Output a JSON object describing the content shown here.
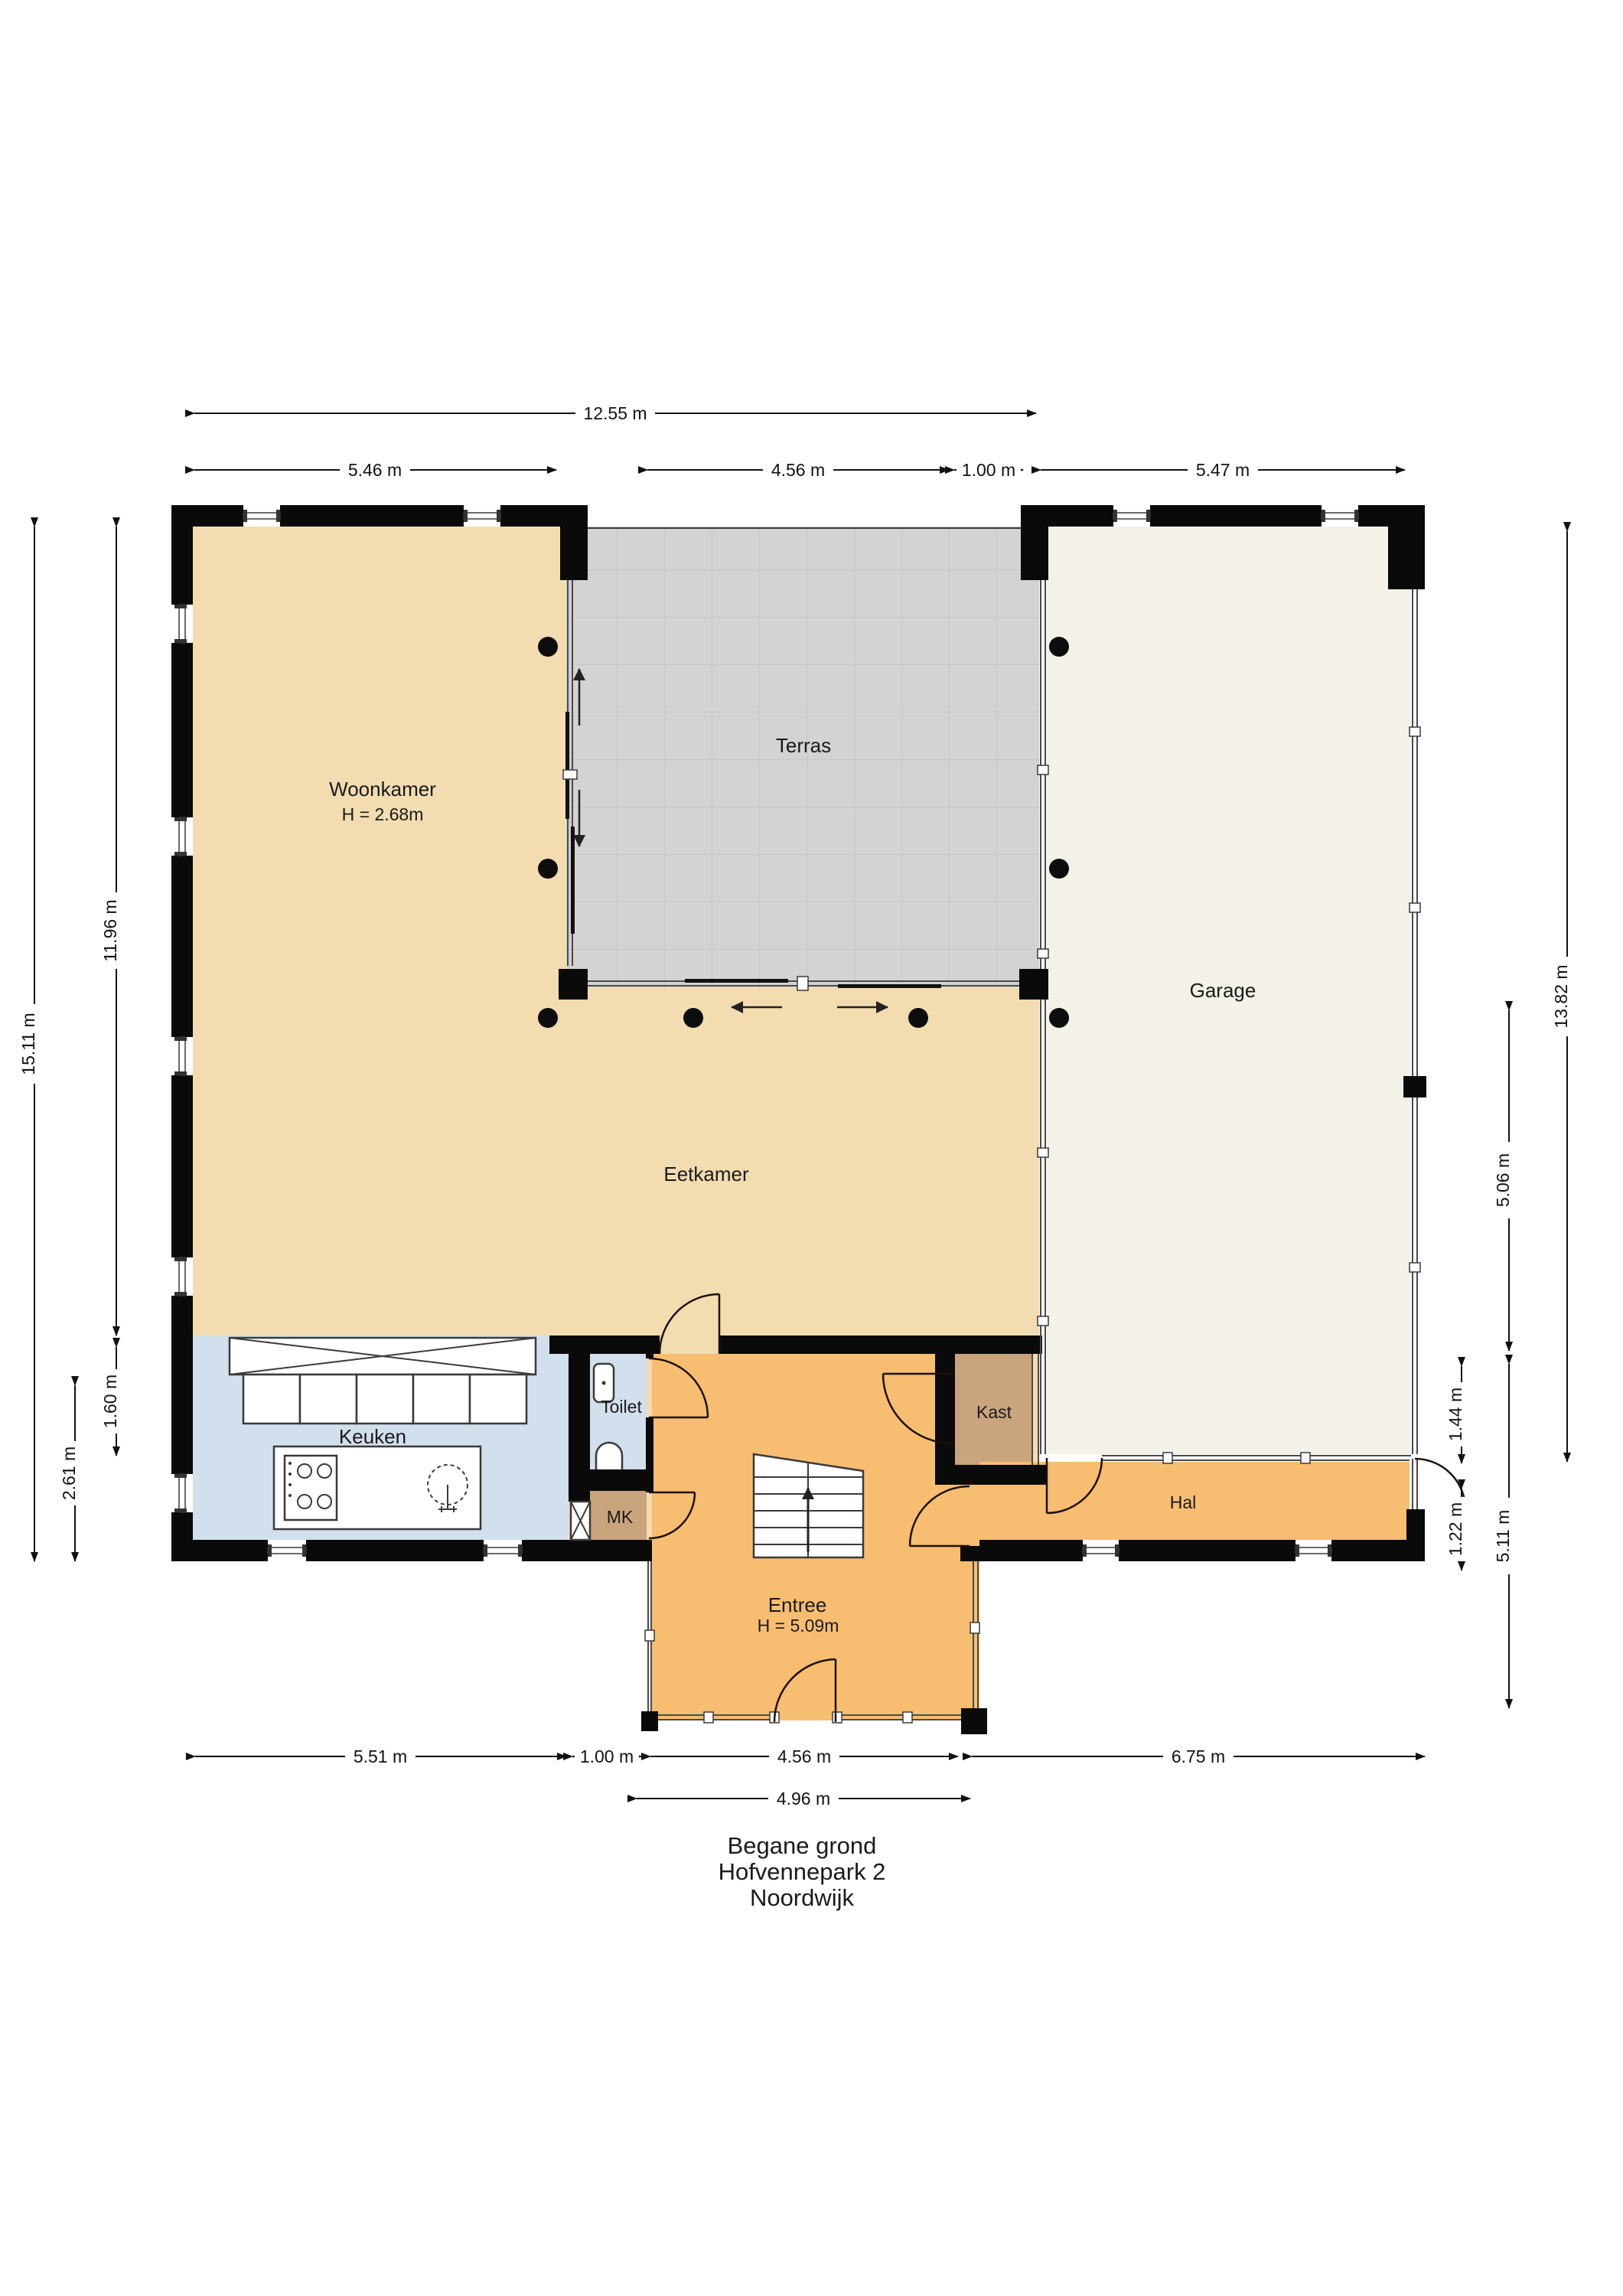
{
  "title_block": {
    "lines": [
      "Begane grond",
      "Hofvennepark 2",
      "Noordwijk"
    ]
  },
  "rooms": {
    "woonkamer": {
      "label": "Woonkamer",
      "height_note": "H = 2.68m"
    },
    "terras": {
      "label": "Terras"
    },
    "garage": {
      "label": "Garage"
    },
    "eetkamer": {
      "label": "Eetkamer"
    },
    "keuken": {
      "label": "Keuken"
    },
    "toilet": {
      "label": "Toilet"
    },
    "mk": {
      "label": "MK"
    },
    "entree": {
      "label": "Entree",
      "height_note": "H = 5.09m"
    },
    "kast": {
      "label": "Kast"
    },
    "hal": {
      "label": "Hal"
    }
  },
  "dimensions": {
    "top": [
      {
        "label": "12.55 m"
      },
      {
        "label": "5.46 m"
      },
      {
        "label": "4.56 m"
      },
      {
        "label": "1.00 m"
      },
      {
        "label": "5.47 m"
      }
    ],
    "bottom": [
      {
        "label": "5.51 m"
      },
      {
        "label": "1.00 m"
      },
      {
        "label": "4.56 m"
      },
      {
        "label": "6.75 m"
      },
      {
        "label": "4.96 m"
      }
    ],
    "left": [
      {
        "label": "15.11 m"
      },
      {
        "label": "11.96 m"
      },
      {
        "label": "1.60 m"
      },
      {
        "label": "2.61 m"
      }
    ],
    "right": [
      {
        "label": "13.82 m"
      },
      {
        "label": "5.06 m"
      },
      {
        "label": "5.11 m"
      },
      {
        "label": "1.44 m"
      },
      {
        "label": "1.22 m"
      }
    ]
  },
  "colors": {
    "living_tan": "#f2dcb0",
    "hall_orange": "#f7bd71",
    "kitchen_blue": "#d2dfed",
    "closet_brown": "#c9a47c",
    "terrace_gray": "#d3d3d3",
    "garage_cream": "#f4f2e8",
    "wall_black": "#0a0a0a"
  }
}
